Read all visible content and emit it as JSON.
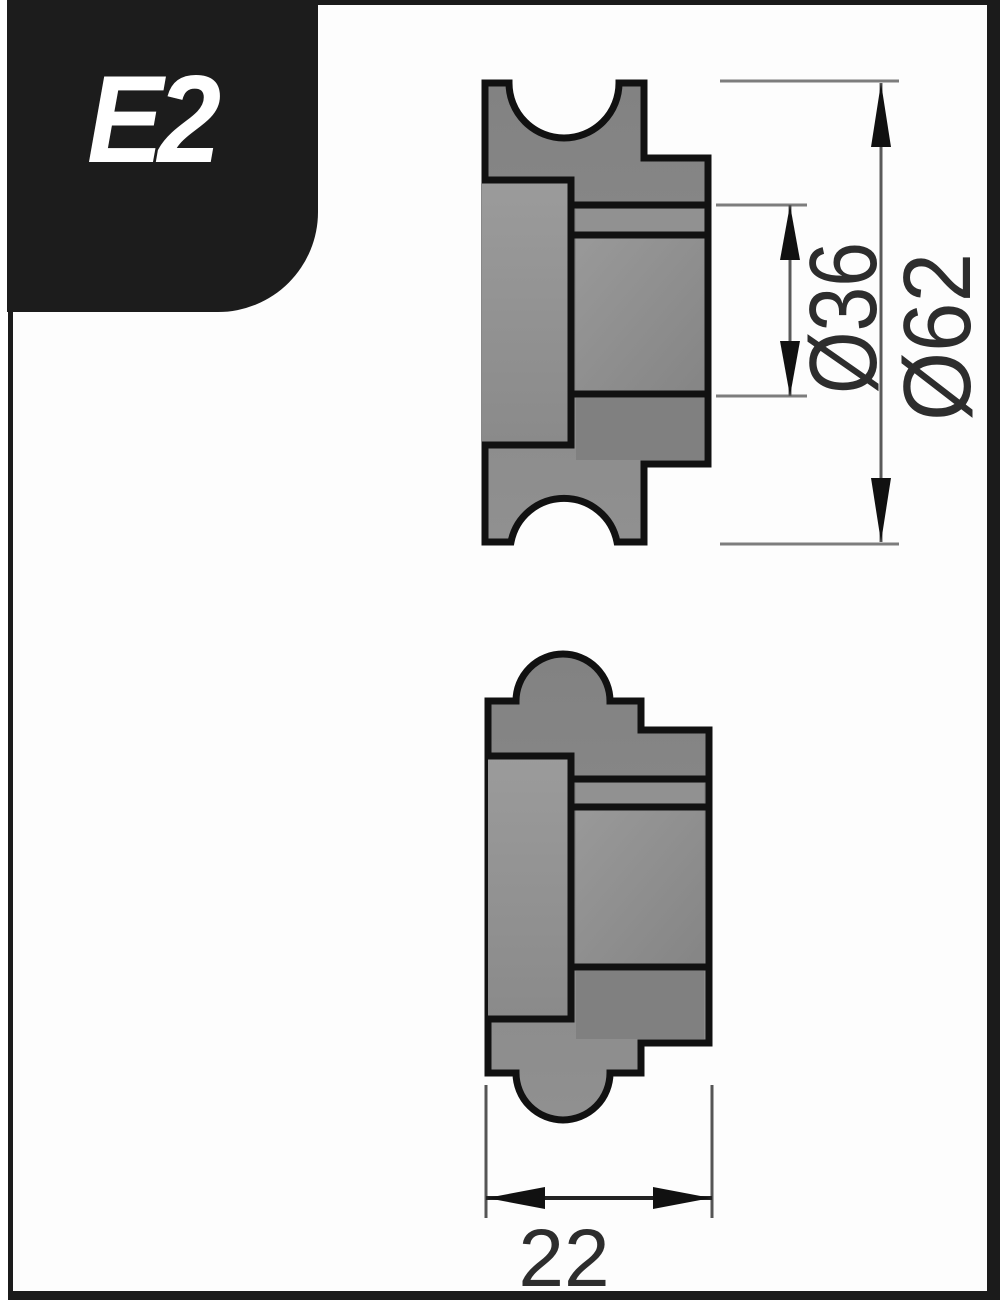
{
  "badge": {
    "label": "E2"
  },
  "drawing": {
    "dimensions": [
      {
        "id": "bore-diameter",
        "label": "Ø36",
        "value": 36,
        "orientation": "vertical"
      },
      {
        "id": "outer-diameter",
        "label": "Ø62",
        "value": 62,
        "orientation": "vertical"
      },
      {
        "id": "roller-width",
        "label": "22",
        "value": 22,
        "orientation": "horizontal"
      }
    ],
    "colors": {
      "body_fill": "#8a8a8a",
      "outline": "#111111",
      "extension_line": "#7d7d7d",
      "dimension_line": "#5a5a5a",
      "arrow": "#111111",
      "badge_background": "#1c1c1c",
      "frame": "#1b1b1b"
    }
  }
}
